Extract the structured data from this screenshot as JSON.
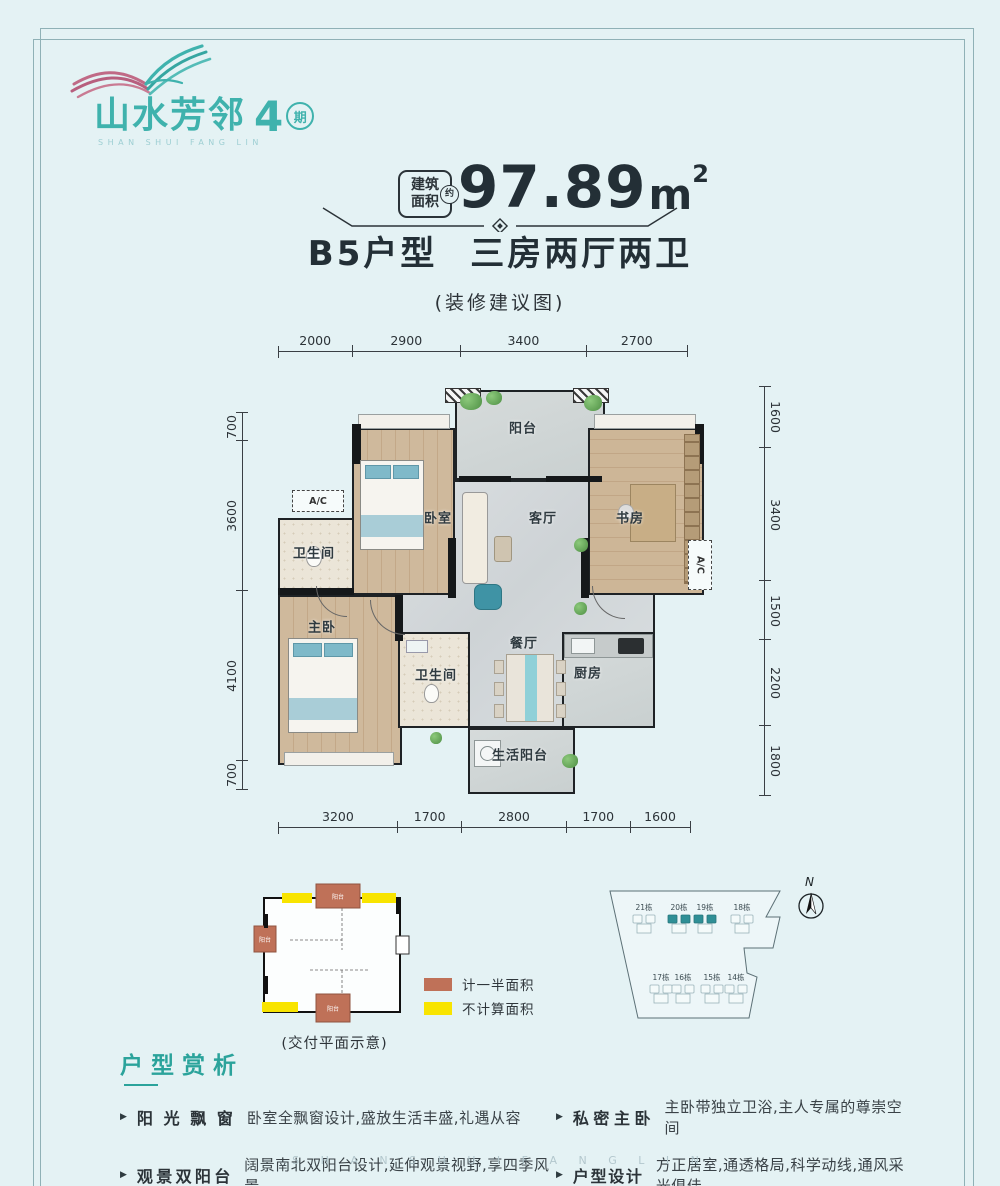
{
  "logo": {
    "name": "山水芳邻",
    "phase_number": "4",
    "phase_suffix": "期",
    "latin": "SHAN SHUI FANG LIN"
  },
  "header": {
    "area_badge_line1": "建筑",
    "area_badge_line2": "面积",
    "area_badge_approx": "约",
    "area_value": "97.89",
    "area_unit": "m",
    "area_exponent": "2",
    "unit_name": "B5户型",
    "unit_layout": "三房两厅两卫",
    "note": "(装修建议图)"
  },
  "plan": {
    "rooms": {
      "balcony": "阳台",
      "bedroom": "卧室",
      "living": "客厅",
      "study": "书房",
      "bath1": "卫生间",
      "master": "主卧",
      "bath2": "卫生间",
      "dining": "餐厅",
      "kitchen": "厨房",
      "service_balcony": "生活阳台",
      "ac": "A/C"
    },
    "dimensions": {
      "top": [
        "2000",
        "2900",
        "3400",
        "2700"
      ],
      "bottom": [
        "3200",
        "1700",
        "2800",
        "1700",
        "1600"
      ],
      "left": [
        "700",
        "3600",
        "4100",
        "700"
      ],
      "right": [
        "1600",
        "3400",
        "1500",
        "2200",
        "1800"
      ]
    }
  },
  "delivery": {
    "caption": "(交付平面示意)",
    "balcony_label": "阳台",
    "legend": [
      {
        "label": "计一半面积",
        "color": "#bf7158"
      },
      {
        "label": "不计算面积",
        "color": "#f8e400"
      }
    ]
  },
  "site": {
    "north_label": "N",
    "buildings": [
      "21栋",
      "20栋",
      "19栋",
      "18栋",
      "17栋",
      "16栋",
      "15栋",
      "14栋"
    ]
  },
  "analysis": {
    "heading": "户型赏析",
    "items": [
      {
        "term": "阳光飘窗",
        "desc": "卧室全飘窗设计,盛放生活丰盛,礼遇从容"
      },
      {
        "term": "观景双阳台",
        "desc": "阔景南北双阳台设计,延伸观景视野,享四季风景"
      },
      {
        "term": "私密主卧",
        "desc": "主卧带独立卫浴,主人专属的尊崇空间"
      },
      {
        "term": "户型设计",
        "desc": "方正居室,通透格局,科学动线,通风采光俱佳"
      }
    ]
  },
  "watermark": "S H A N S H U I F A N G L I N",
  "colors": {
    "background": "#e4f2f4",
    "brand_teal": "#3fb2ad",
    "heading_teal": "#2ba39b",
    "highlight_teal": "#2f8f96",
    "legend_orange": "#bf7158",
    "legend_yellow": "#f8e400",
    "dark_text": "#232f36"
  }
}
